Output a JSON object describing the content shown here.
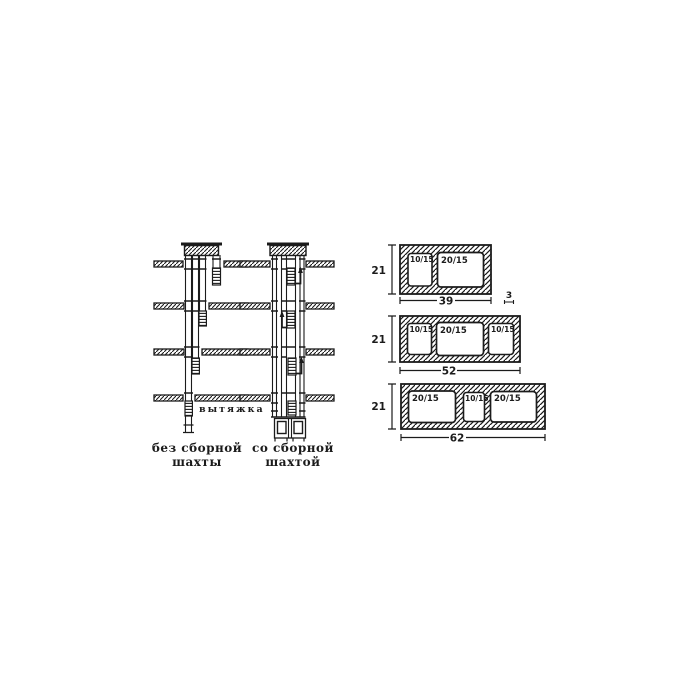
{
  "figure": {
    "kind": "scanned-technical-diagram",
    "ink_color": "#1b1b1b",
    "paper_color": "#ffffff"
  },
  "shaft_diagrams": {
    "exhaust_label": "вытяжка",
    "without_collector": {
      "caption_line1": "без сборной",
      "caption_line2": "шахты"
    },
    "with_collector": {
      "caption_line1": "со сборной",
      "caption_line2": "шахтой"
    }
  },
  "block_sections": {
    "height_label": "21",
    "wall_thickness_label": "3",
    "items": [
      {
        "width_label": "39",
        "openings": [
          "10/15",
          "20/15"
        ]
      },
      {
        "width_label": "52",
        "openings": [
          "10/15",
          "20/15",
          "10/15"
        ]
      },
      {
        "width_label": "62",
        "openings": [
          "20/15",
          "10/15",
          "20/15"
        ]
      }
    ]
  }
}
